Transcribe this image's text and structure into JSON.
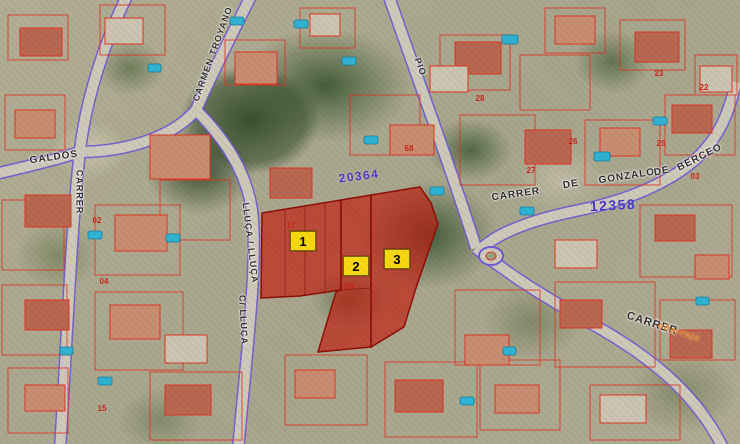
{
  "map_title": "Cadastral aerial viewer with highlighted parcels 1-3",
  "colors": {
    "cadastral_red": "#e03522",
    "highlight_fill": "#c41a0c",
    "highlight_stroke": "#8f0f06",
    "road_edge_purple": "#6f5bd6",
    "road_fill_tan": "#cfc9ba",
    "marker_yellow": "#f7d911",
    "zone_number_purple": "#4b39c9",
    "house_number_red": "#cc2418",
    "street_text_dark": "#2f2f2f",
    "overlay_text_orange": "#e8821e",
    "pool_cyan": "#2fb3d4"
  },
  "parcel_markers": [
    {
      "label": "1",
      "x": 303,
      "y": 241
    },
    {
      "label": "2",
      "x": 356,
      "y": 266
    },
    {
      "label": "3",
      "x": 397,
      "y": 259
    }
  ],
  "street_labels": [
    {
      "text": "CARMEN TROYANO",
      "x": 213,
      "y": 54,
      "rot": -70,
      "size": 9
    },
    {
      "text": "GALDOS",
      "x": 54,
      "y": 158,
      "rot": -8,
      "size": 10
    },
    {
      "text": "CARRER",
      "x": 79,
      "y": 192,
      "rot": 90,
      "size": 9
    },
    {
      "text": "LLUÇA / LLUÇA",
      "x": 250,
      "y": 243,
      "rot": 83,
      "size": 9
    },
    {
      "text": "C/ LLUÇA",
      "x": 243,
      "y": 320,
      "rot": 87,
      "size": 9
    },
    {
      "text": "PIO",
      "x": 420,
      "y": 67,
      "rot": 70,
      "size": 9
    },
    {
      "text": "CARRER",
      "x": 516,
      "y": 195,
      "rot": -8,
      "size": 10
    },
    {
      "text": "DE",
      "x": 571,
      "y": 185,
      "rot": -10,
      "size": 10
    },
    {
      "text": "GONZALO",
      "x": 627,
      "y": 177,
      "rot": -9,
      "size": 10
    },
    {
      "text": "DE",
      "x": 662,
      "y": 172,
      "rot": -12,
      "size": 10
    },
    {
      "text": "BERCEO",
      "x": 700,
      "y": 158,
      "rot": -27,
      "size": 10
    },
    {
      "text": "CARRER",
      "x": 652,
      "y": 324,
      "rot": 18,
      "size": 11
    }
  ],
  "overlay_labels": [
    {
      "text": "obarroja",
      "x": 679,
      "y": 332,
      "rot": 18,
      "size": 9
    }
  ],
  "zone_numbers": [
    {
      "text": "20364",
      "x": 359,
      "y": 176,
      "rot": -7,
      "size": 12
    },
    {
      "text": "12358",
      "x": 613,
      "y": 205,
      "rot": -3,
      "size": 14
    }
  ],
  "house_numbers": [
    {
      "text": "17",
      "x": 291,
      "y": 226
    },
    {
      "text": "09",
      "x": 349,
      "y": 287
    },
    {
      "text": "26",
      "x": 573,
      "y": 142
    },
    {
      "text": "25",
      "x": 661,
      "y": 144
    },
    {
      "text": "27",
      "x": 531,
      "y": 171
    },
    {
      "text": "03",
      "x": 695,
      "y": 177
    },
    {
      "text": "15",
      "x": 102,
      "y": 409
    },
    {
      "text": "23",
      "x": 659,
      "y": 74
    },
    {
      "text": "28",
      "x": 480,
      "y": 99
    },
    {
      "text": "68",
      "x": 409,
      "y": 149
    },
    {
      "text": "02",
      "x": 97,
      "y": 221
    },
    {
      "text": "04",
      "x": 104,
      "y": 282
    },
    {
      "text": "22",
      "x": 704,
      "y": 88
    }
  ]
}
